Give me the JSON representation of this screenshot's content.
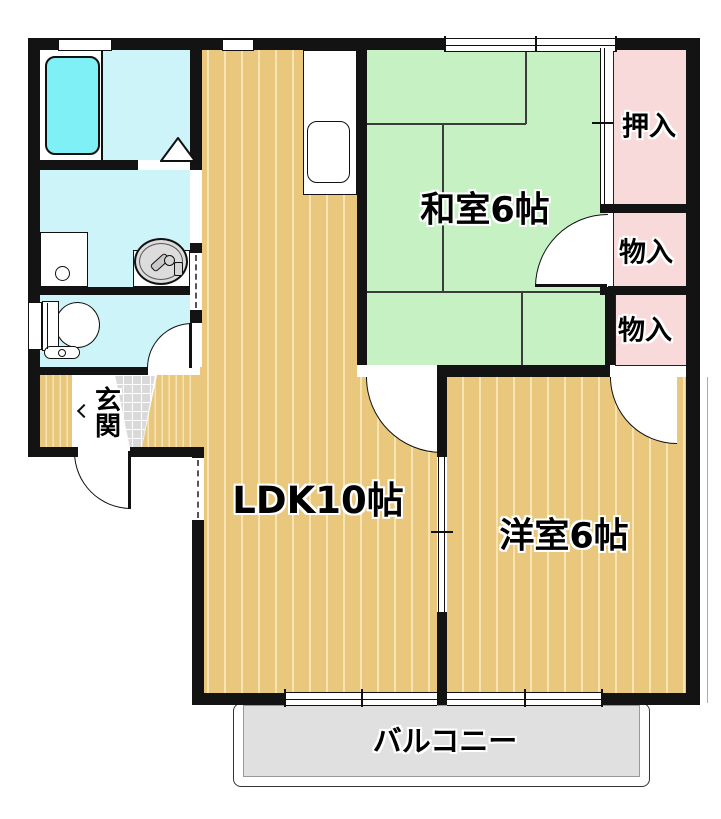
{
  "title": "2DK apartment floor plan",
  "rooms": {
    "ldk": {
      "label": "LDK10帖"
    },
    "washitsu": {
      "label": "和室6帖"
    },
    "yoshitsu": {
      "label": "洋室6帖"
    },
    "oshiire": {
      "label": "押入"
    },
    "monoire_upper": {
      "label": "物入"
    },
    "monoire_lower": {
      "label": "物入"
    },
    "genkan": {
      "label": "玄関"
    },
    "balcony": {
      "label": "バルコニー"
    }
  },
  "colors": {
    "wall": "#131313",
    "wood_floor": "#E9C87E",
    "wood_stripe": "#F6E4B5",
    "tatami_green": "#C5F1C3",
    "closet_pink": "#F9DADA",
    "wet_room_cyan": "#CDF5F9",
    "bathtub_cyan": "#7FF0F6",
    "genkan_tile_gray": "#D9D9D9",
    "balcony_gray": "#E0E0E0"
  },
  "fixtures": [
    "bathtub",
    "bathroom-folding-door",
    "washing-machine-pan",
    "washbasin",
    "toilet",
    "kitchen-counter",
    "kitchen-sink",
    "sliding-windows",
    "hinged-doors",
    "closet-fusuma"
  ]
}
